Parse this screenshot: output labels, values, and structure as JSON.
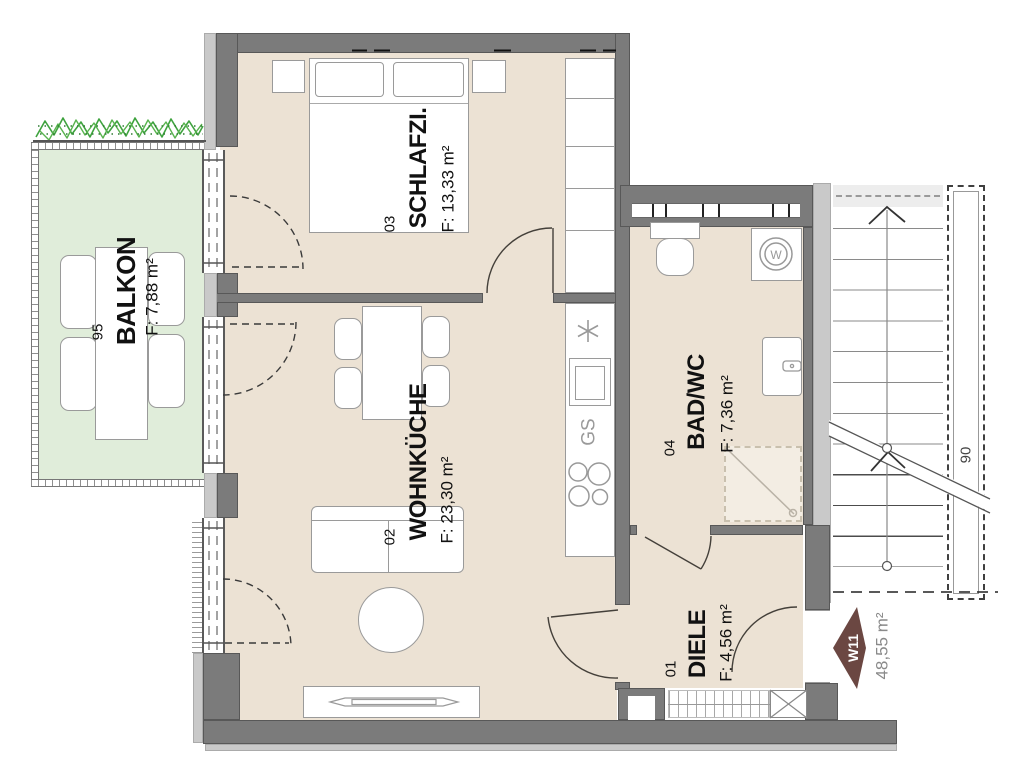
{
  "plan_title": "Wohnung W11 Grundriss",
  "unit": {
    "id": "W11",
    "area": "48,55 m²"
  },
  "rooms": {
    "balkon": {
      "number": "95",
      "name": "BALKON",
      "area": "F: 7,88 m²"
    },
    "schlafzimmer": {
      "number": "03",
      "name": "SCHLAFZI.",
      "area": "F: 13,33 m²"
    },
    "wohnkueche": {
      "number": "02",
      "name": "WOHNKÜCHE",
      "area": "F: 23,30 m²"
    },
    "bad": {
      "number": "04",
      "name": "BAD/WC",
      "area": "F: 7,36 m²"
    },
    "diele": {
      "number": "01",
      "name": "DIELE",
      "area": "F: 4,56 m²"
    }
  },
  "labels": {
    "stairwell": "90",
    "dishwasher": "GS",
    "washer": "W"
  },
  "colors": {
    "floor": "#ece2d4",
    "balcony": "#e0edda",
    "wall": "#7b7b7b",
    "trim": "#c9c9c9",
    "unit_marker": "#6b4742",
    "hedge": "#3fa33f"
  }
}
